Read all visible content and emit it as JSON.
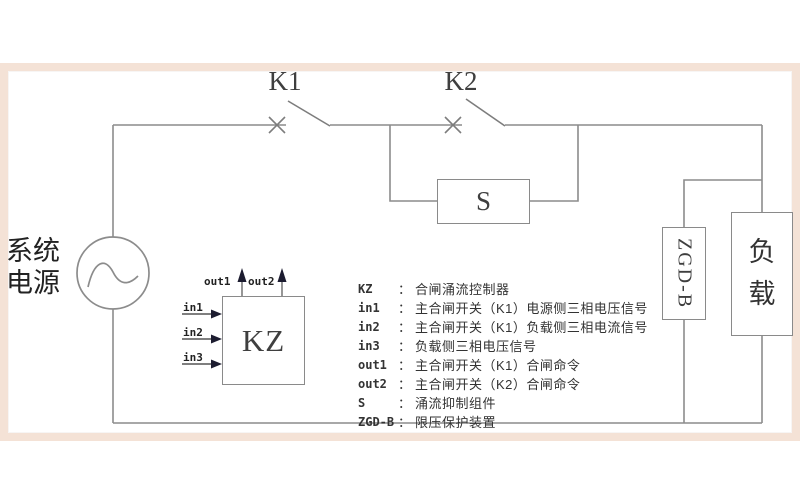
{
  "schematic": {
    "source_label": "系统电源",
    "switches": {
      "k1": "K1",
      "k2": "K2"
    },
    "boxes": {
      "s": "S",
      "kz": "KZ",
      "zgdb": "ZGD-B",
      "load": "负载"
    },
    "kz_ports": {
      "in1": "in1",
      "in2": "in2",
      "in3": "in3",
      "out1": "out1",
      "out2": "out2"
    }
  },
  "legend": {
    "colon": "：",
    "items": [
      {
        "key": "KZ",
        "desc": "合闸涌流控制器"
      },
      {
        "key": "in1",
        "desc": "主合闸开关（K1）电源侧三相电压信号"
      },
      {
        "key": "in2",
        "desc": "主合闸开关（K1）负载侧三相电流信号"
      },
      {
        "key": "in3",
        "desc": "负载侧三相电压信号"
      },
      {
        "key": "out1",
        "desc": "主合闸开关（K1）合闸命令"
      },
      {
        "key": "out2",
        "desc": "主合闸开关（K2）合闸命令"
      },
      {
        "key": "S",
        "desc": "涌流抑制组件"
      },
      {
        "key": "ZGD-B",
        "desc": "限压保护装置"
      }
    ]
  },
  "colors": {
    "frame": "#f4e2d6",
    "wire": "#8c8c8c",
    "text": "#3a3a3a",
    "arrow": "#1c1c30"
  }
}
